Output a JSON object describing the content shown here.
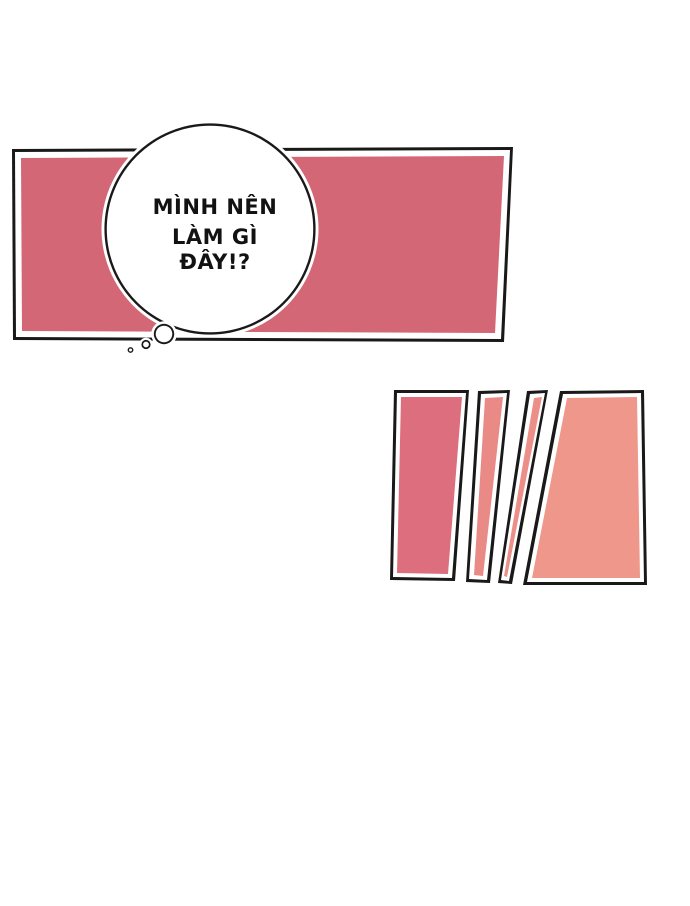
{
  "page": {
    "kind": "webtoon-comic-panel",
    "background": "#ffffff"
  },
  "panel": {
    "outline_color": "#191919",
    "inner_border_color": "#ffffff",
    "fill": "#d46775"
  },
  "thought_bubble": {
    "fill": "#ffffff",
    "outline_color": "#191919",
    "text_color": "#121212",
    "lines": [
      "MÌNH NÊN",
      "LÀM GÌ",
      "ĐÂY!?"
    ]
  },
  "shards": {
    "outline_color": "#191919",
    "gap_color": "#ffffff",
    "items": [
      {
        "fill": "#dd6e7d"
      },
      {
        "fill": "#ea8a86"
      },
      {
        "fill": "#ec8f88"
      },
      {
        "fill": "#f0978b"
      }
    ]
  }
}
